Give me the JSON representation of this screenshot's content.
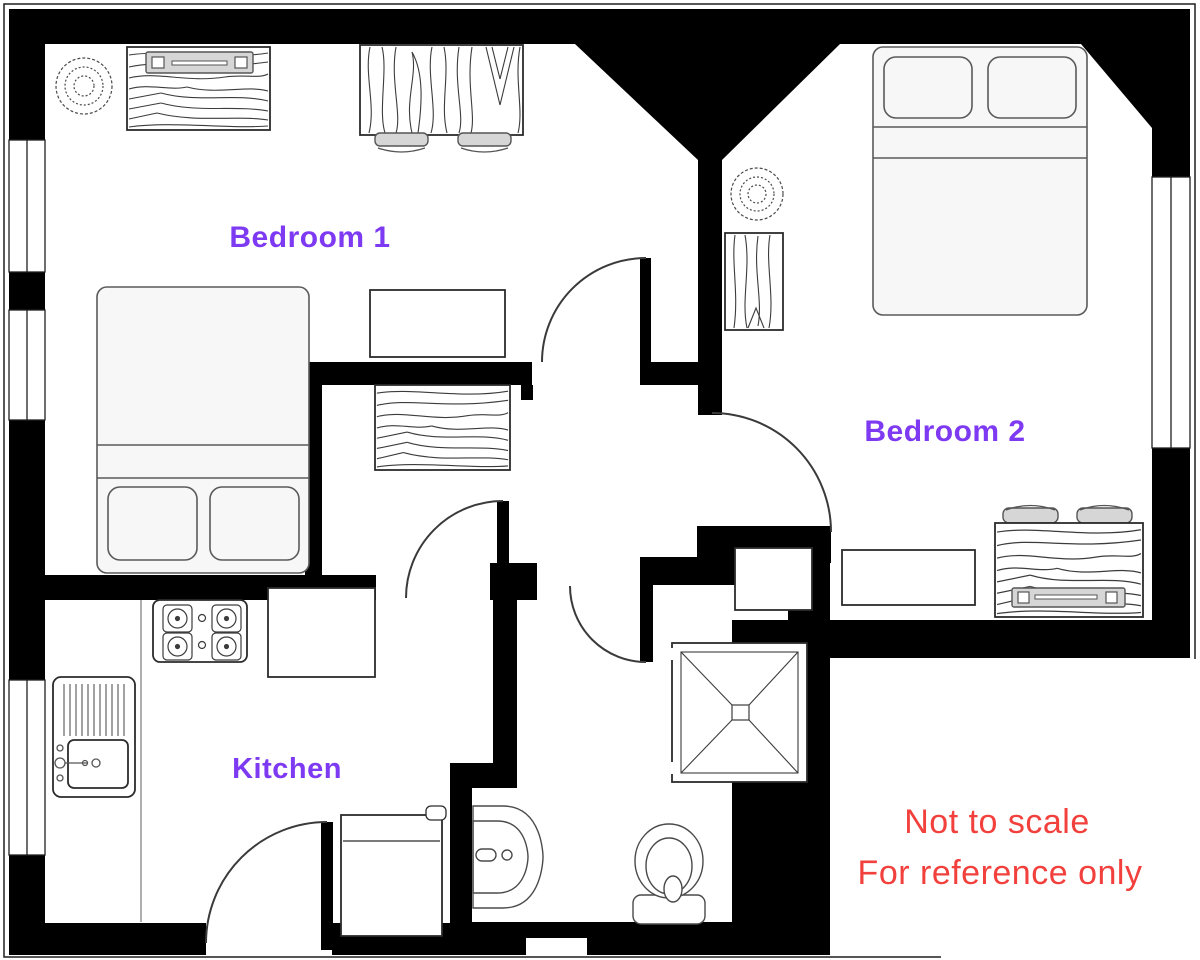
{
  "plan": {
    "rooms": [
      {
        "id": "bedroom-1",
        "label": "Bedroom 1"
      },
      {
        "id": "bedroom-2",
        "label": "Bedroom 2"
      },
      {
        "id": "kitchen",
        "label": "Kitchen"
      }
    ],
    "disclaimer": {
      "line1": "Not to scale",
      "line2": "For reference only"
    },
    "colors": {
      "room_label": "#7e3af2",
      "disclaimer": "#f2403c",
      "walls": "#000000",
      "background": "#ffffff"
    }
  }
}
